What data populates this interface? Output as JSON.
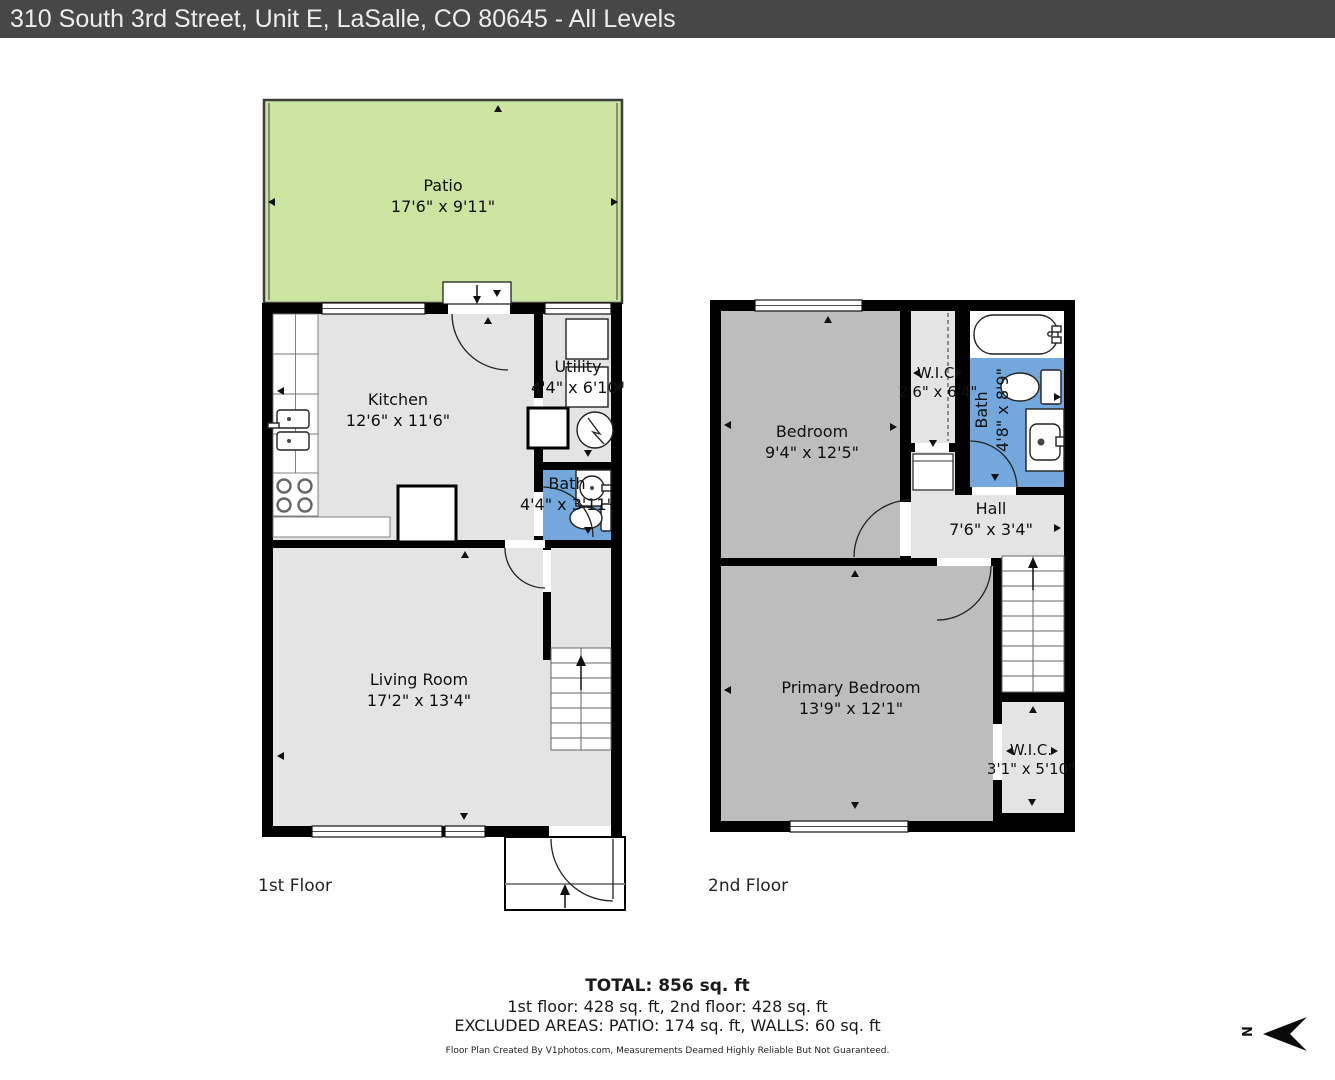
{
  "title_bar": {
    "text": "310 South 3rd Street, Unit E, LaSalle, CO 80645 - All Levels"
  },
  "floor1": {
    "caption": "1st Floor",
    "patio": {
      "name": "Patio",
      "dims": "17'6\" x 9'11\""
    },
    "kitchen": {
      "name": "Kitchen",
      "dims": "12'6\" x 11'6\""
    },
    "utility": {
      "name": "Utility",
      "dims": "4'4\" x 6'10\""
    },
    "bath": {
      "name": "Bath",
      "dims": "4'4\" x 3'11\""
    },
    "living": {
      "name": "Living Room",
      "dims": "17'2\" x 13'4\""
    }
  },
  "floor2": {
    "caption": "2nd Floor",
    "bedroom": {
      "name": "Bedroom",
      "dims": "9'4\" x 12'5\""
    },
    "wic_top": {
      "name": "W.I.C.",
      "dims": "2'6\" x 6'4\""
    },
    "bath": {
      "name": "Bath",
      "dims": "4'8\" x 8'9\""
    },
    "hall": {
      "name": "Hall",
      "dims": "7'6\" x 3'4\""
    },
    "primary_bedroom": {
      "name": "Primary Bedroom",
      "dims": "13'9\" x 12'1\""
    },
    "wic_bottom": {
      "name": "W.I.C.",
      "dims": "3'1\" x 5'10\""
    }
  },
  "summary": {
    "total": "TOTAL: 856 sq. ft",
    "floors_line": "1st floor: 428 sq. ft, 2nd floor: 428 sq. ft",
    "excluded_line": "EXCLUDED AREAS: PATIO: 174 sq. ft, WALLS: 60 sq. ft"
  },
  "credit": "Floor Plan Created By V1photos.com, Measurements Deamed Highly Reliable But Not Guaranteed.",
  "compass": {
    "label": "N"
  },
  "colors": {
    "title_bg": "#474747",
    "title_text": "#ededed",
    "patio_green": "#cbe5a1",
    "floor_light_gray": "#e4e4e4",
    "floor_dark_gray": "#bdbdbd",
    "bath_blue": "#74a7dc",
    "wall_black": "#000000"
  }
}
